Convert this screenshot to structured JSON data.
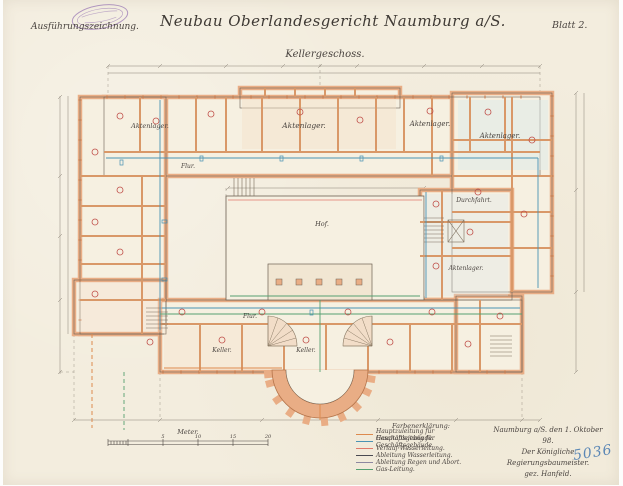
{
  "sheet": {
    "annotation_top_left": "Ausführungszeichnung.",
    "title": "Neubau Oberlandesgericht Naumburg a/S.",
    "sheet_number": "Blatt 2.",
    "floor_label": "Kellergeschoss.",
    "archive_number": "5036"
  },
  "stamp": {
    "shape": "oval-registry-stamp",
    "color": "#9b7ab5"
  },
  "plan": {
    "labels": {
      "aktenlager": "Aktenlager.",
      "flur": "Flur.",
      "keller": "Keller.",
      "hof": "Hof.",
      "durchfahrt": "Durchfahrt."
    }
  },
  "scale_bar": {
    "label": "Meter.",
    "ticks": [
      "5",
      "10",
      "15",
      "20"
    ]
  },
  "legend": {
    "heading": "Farbenerklärung:",
    "entries": [
      {
        "label": "Hauptzuleitung für Geschäftsgebäude.",
        "color": "#dd8a4e"
      },
      {
        "label": "Hauptableitung für Geschäftsgebäude.",
        "color": "#4b93b4"
      },
      {
        "label": "Verlauf Wasserleitung.",
        "color": "#e2796b"
      },
      {
        "label": "Ableitung Wasserleitung.",
        "color": "#4a4a52"
      },
      {
        "label": "Ableitung Regen und Abort.",
        "color": "#8d87a0"
      },
      {
        "label": "Gas-Leitung.",
        "color": "#55a071"
      }
    ]
  },
  "signature": {
    "line1": "Naumburg a/S. den 1. Oktober 98.",
    "line2": "Der Königliche Regierungsbaumeister.",
    "line3": "gez. Hanfeld."
  },
  "colors": {
    "paper": "#f3edde",
    "wall_fill": "#e9ad85",
    "wall_line": "#c97f52",
    "ink": "#6d6052",
    "dimension_gray": "#8a8276",
    "water_blue": "#4b93b4",
    "drain_green": "#55a071",
    "accent_orange": "#dd8a4e",
    "room_number_red": "#c0504a",
    "archive_blue": "#5b87b5",
    "stamp_purple": "#9b7ab5"
  }
}
